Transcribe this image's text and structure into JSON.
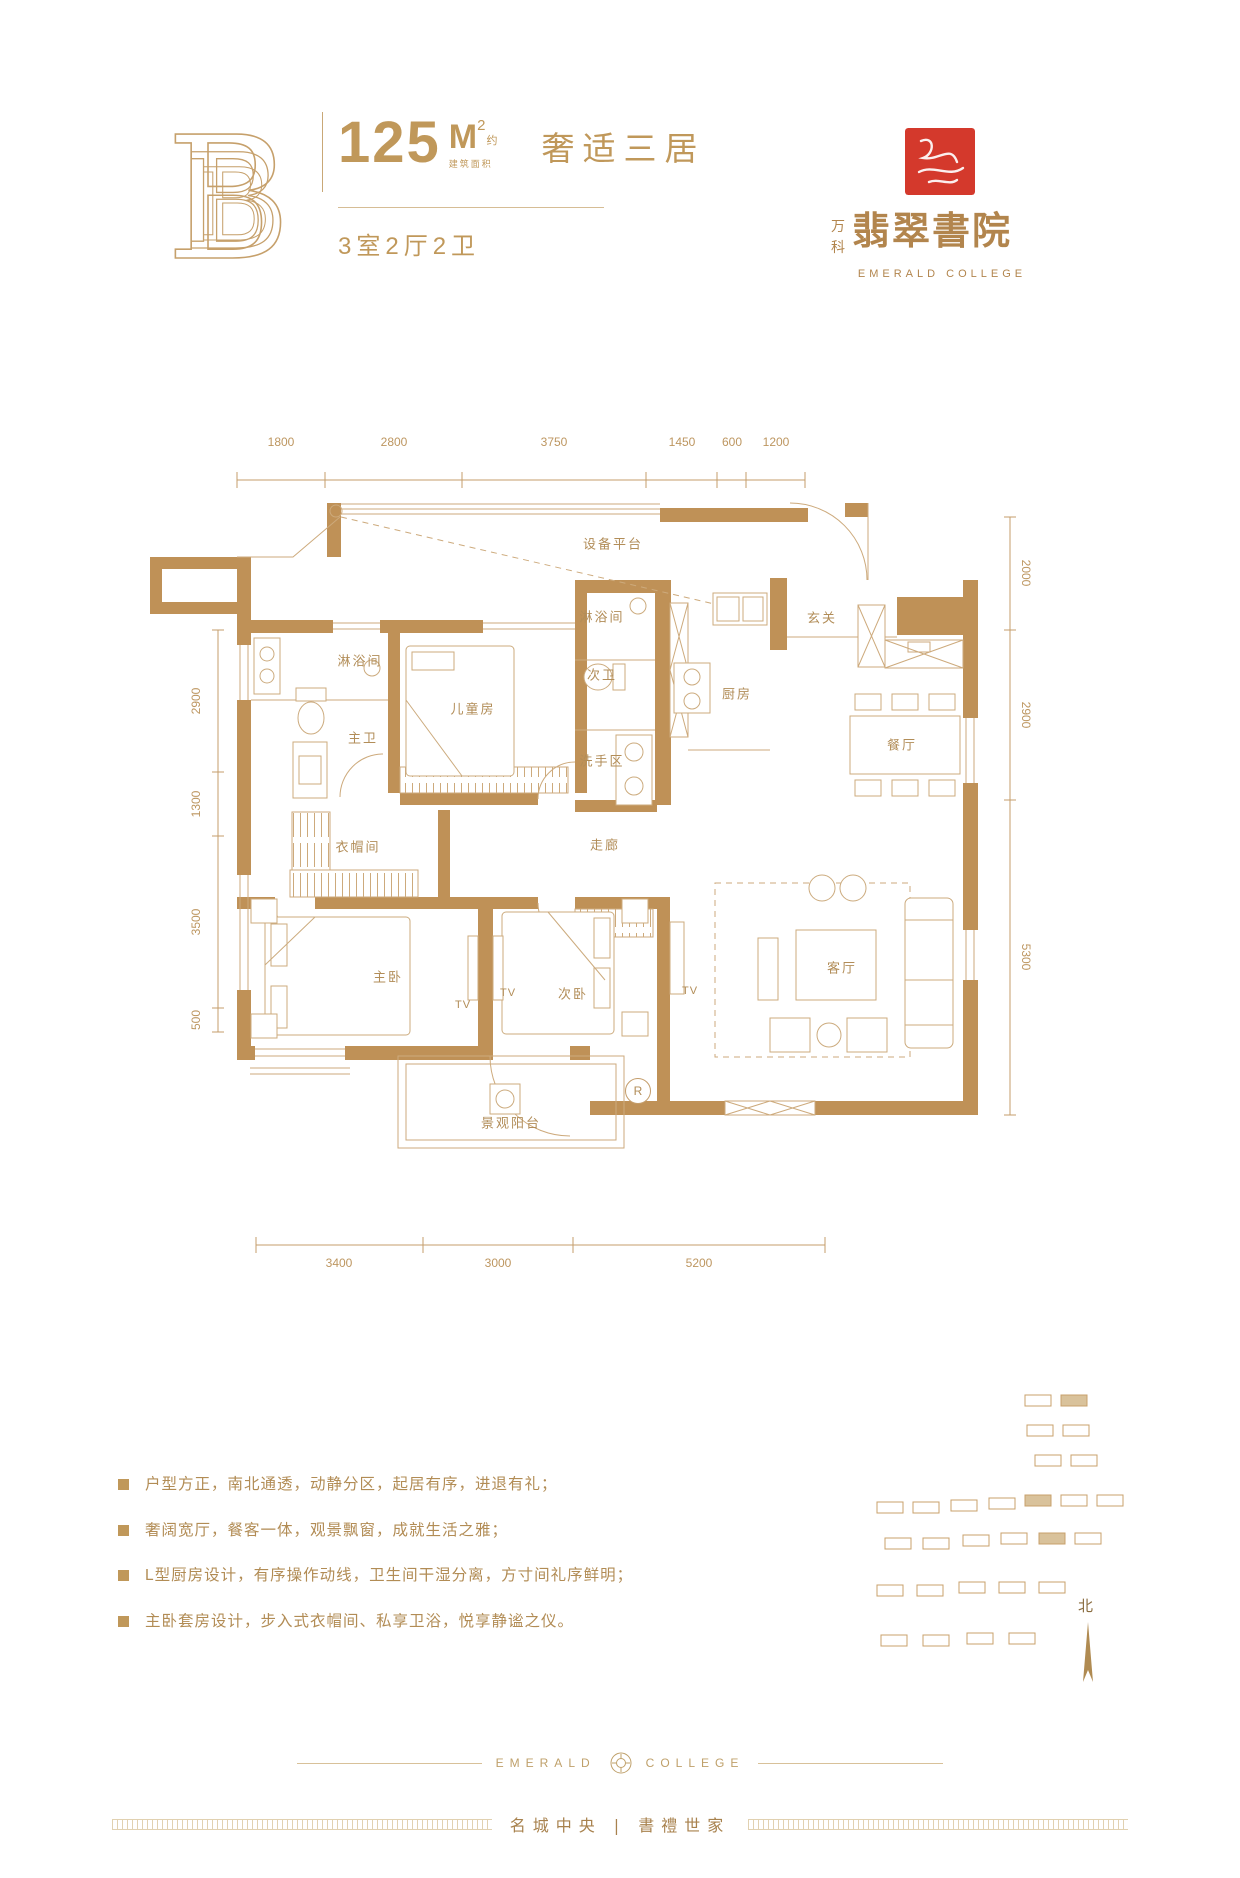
{
  "header": {
    "unit_letter": "B",
    "area_number": "125",
    "area_unit": "M",
    "area_sup": "2",
    "area_approx": "约",
    "area_caption": "建筑面积",
    "headline": "奢适三居",
    "spec": "3室2厅2卫"
  },
  "brand": {
    "prefix_top": "万",
    "prefix_bottom": "科",
    "name_cn": "翡翠書院",
    "name_en": "EMERALD COLLEGE"
  },
  "plan": {
    "dims_top": [
      "1800",
      "2800",
      "3750",
      "1450",
      "600",
      "1200"
    ],
    "dims_left": [
      "2900",
      "1300",
      "3500",
      "500"
    ],
    "dims_right": [
      "2000",
      "2900",
      "5300"
    ],
    "dims_bottom": [
      "3400",
      "3000",
      "5200"
    ],
    "rooms": {
      "equipment": "设备平台",
      "shower1": "淋浴间",
      "master_bath": "主卫",
      "kids_room": "儿童房",
      "shower2": "淋浴间",
      "second_bath": "次卫",
      "wash_area": "洗手区",
      "kitchen": "厨房",
      "foyer": "玄关",
      "dining": "餐厅",
      "cloakroom": "衣帽间",
      "corridor": "走廊",
      "master_bedroom": "主卧",
      "second_bedroom": "次卧",
      "living": "客厅",
      "balcony": "景观阳台"
    },
    "tv_label": "TV",
    "r_label": "R"
  },
  "features": [
    "户型方正，南北通透，动静分区，起居有序，进退有礼；",
    "奢阔宽厅，餐客一体，观景飘窗，成就生活之雅；",
    "L型厨房设计，有序操作动线，卫生间干湿分离，方寸间礼序鲜明；",
    "主卧套房设计，步入式衣帽间、私享卫浴，悦享静谧之仪。"
  ],
  "site": {
    "north": "北"
  },
  "footer": {
    "en_left": "EMERALD",
    "en_right": "COLLEGE",
    "slogan": "名城中央 | 書禮世家"
  }
}
